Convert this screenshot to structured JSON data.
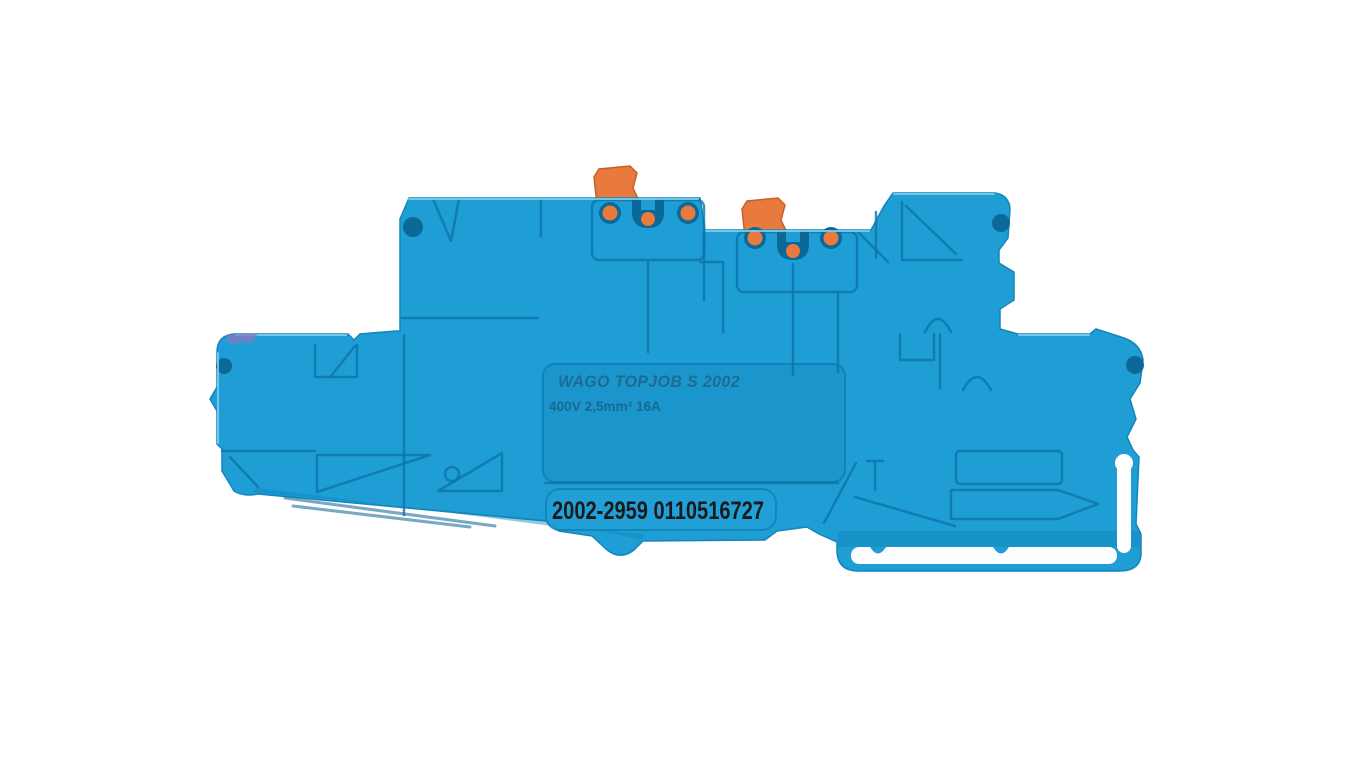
{
  "window": {
    "background": "#ffffff"
  },
  "subject": {
    "type": "terminal-block-product-photo",
    "body_color": "#1f9ed6",
    "panel_color": "#1b96cc",
    "recess_color": "#22a1d8",
    "groove_color": "#0d74a8",
    "highlight_color": "#7ccbec",
    "hole_color": "#0b6898",
    "lever_color": "#e87a3e",
    "port_color": "#e87a3e",
    "mold_mark_color": "#8a77bd",
    "marking_panel": {
      "brand_line": "WAGO TOPJOB S  2002",
      "rating_line": "400V 2,5mm² 16A",
      "emboss_color": "#1d6a8f",
      "rating_color": "#17648c"
    },
    "print_label": {
      "text": "2002-2959 0110516727",
      "text_color": "#1a1a1a"
    }
  }
}
